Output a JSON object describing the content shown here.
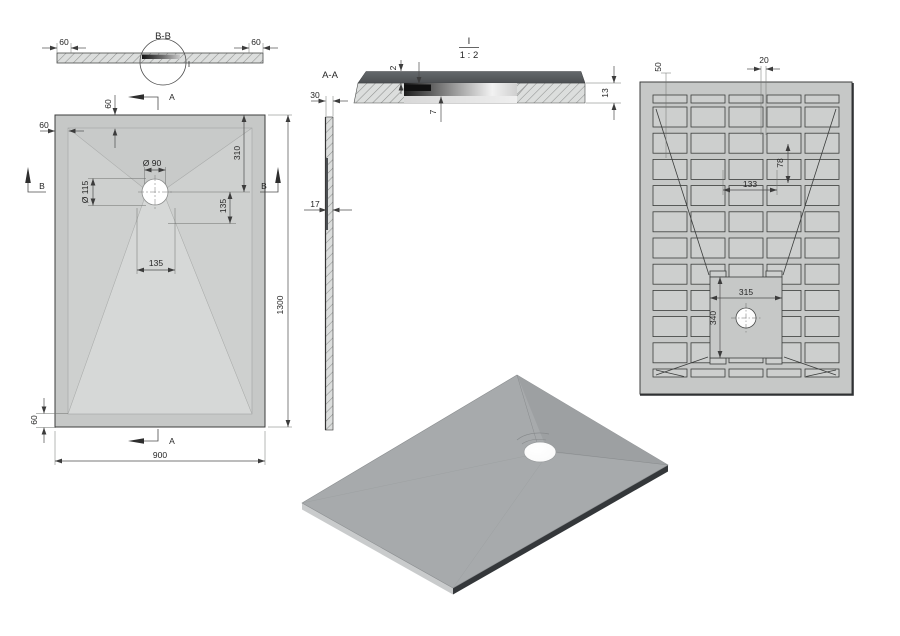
{
  "sheet": {
    "background": "#ffffff"
  },
  "views": {
    "section_bb": {
      "title": "B-B",
      "dim_edge_left": "60",
      "dim_edge_right": "60",
      "detail_mark": "I"
    },
    "plan": {
      "marker_a": "A",
      "marker_b": "B",
      "dim_rim_left": "60",
      "dim_rim_top": "60",
      "dim_rim_bottom": "60",
      "dim_drain_dia": "Ø 90",
      "dim_recess_dia": "Ø 115",
      "dim_drain_from_top": "310",
      "dim_drain_offset_v": "135",
      "dim_drain_offset_h": "135",
      "dim_length": "1300",
      "dim_width": "900"
    },
    "section_aa": {
      "title": "A-A",
      "dim_height": "30",
      "dim_wall": "17"
    },
    "detail_i": {
      "title": "I",
      "scale": "1 : 2",
      "dim_lip": "2",
      "dim_depth": "7",
      "dim_total": "13"
    },
    "bottom": {
      "dim_edge": "50",
      "dim_rib": "20",
      "dim_pocket_h": "78",
      "dim_pocket_w": "133",
      "dim_recess_w": "315",
      "dim_recess_h": "340"
    }
  },
  "colors": {
    "tray_surface": "#d3d5d4",
    "tray_rim": "#c6c8c7",
    "pocket_gray": "#cdcfce",
    "iso_face": "#a7aaac",
    "edge_dark": "#34373a",
    "detail_band_dark": "#54585b"
  }
}
